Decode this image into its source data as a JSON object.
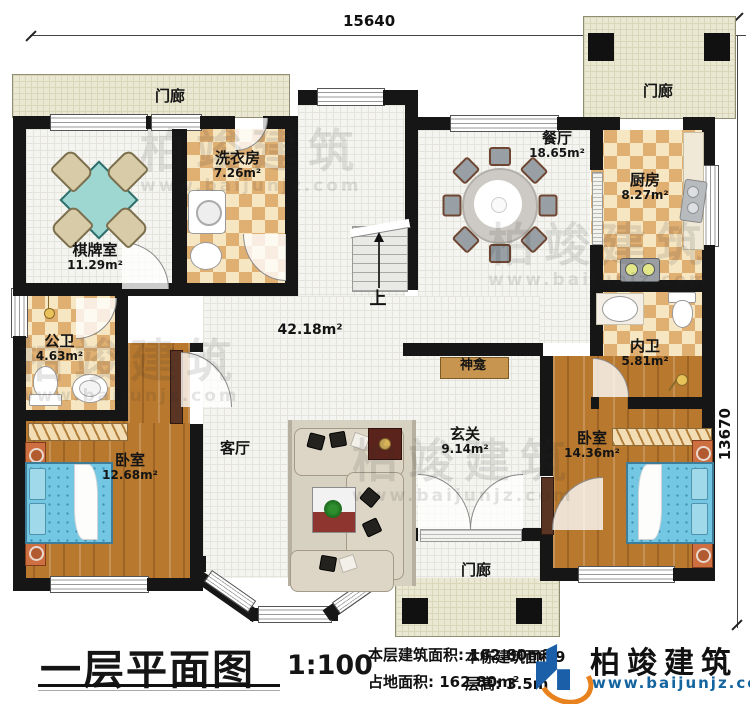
{
  "dimensions": {
    "top": "15640",
    "right": "13670"
  },
  "porch": {
    "label": "门廊"
  },
  "rooms": [
    {
      "name": "棋牌室",
      "area": "11.29m²"
    },
    {
      "name": "洗衣房",
      "area": "7.26m²"
    },
    {
      "name": "餐厅",
      "area": "18.65m²"
    },
    {
      "name": "厨房",
      "area": "8.27m²"
    },
    {
      "name": "公卫",
      "area": "4.63m²"
    },
    {
      "name": "内卫",
      "area": "5.81m²"
    },
    {
      "name": "卧室",
      "area": "12.68m²"
    },
    {
      "name": "卧室",
      "area": "14.36m²"
    },
    {
      "name": "客厅",
      "area": ""
    },
    {
      "name": "玄关",
      "area": "9.14m²"
    }
  ],
  "labels": {
    "living_area": "42.18m²",
    "shrine": "神龛",
    "stairs_up": "上"
  },
  "legend": {
    "title": "一层平面图",
    "scale": "1:100",
    "floor_area_label": "本层建筑面积:",
    "floor_area_value": "162.80m²",
    "land_area_label": "占地面积:",
    "land_area_value": "162.80m²",
    "building_area_label": "本栋建筑面积",
    "building_area_visible": "9",
    "height_label": "层高:",
    "height_value": "3.5m"
  },
  "logo": {
    "name": "柏竣建筑",
    "url": "www.baijunjz.com"
  },
  "watermark": {
    "text": "柏竣建筑",
    "url": "www.baijunjz.com"
  },
  "colors": {
    "wall": "#161616",
    "checker_tile": "#e0af72",
    "wood_floor": "#b8792f",
    "bed_teal": "#74c7e2",
    "porch_beige": "#eae8d2",
    "shrine_brown": "#c89550",
    "logo_blue": "#1a5fa8",
    "logo_orange": "#e8821e",
    "url_blue": "#1464a0"
  }
}
